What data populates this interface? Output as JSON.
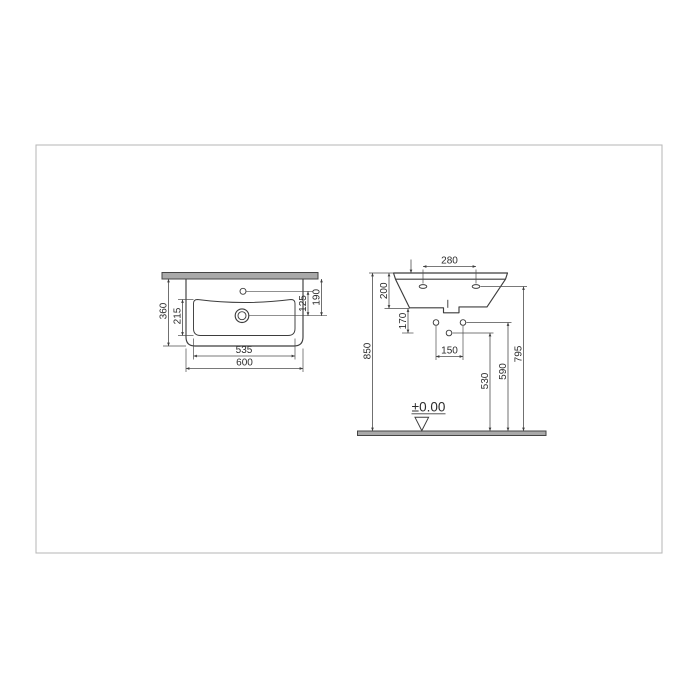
{
  "drawing": {
    "type": "technical-installation-drawing",
    "subject": "wall-hung washbasin dimensions (mm)",
    "plan_view": {
      "overall_width": "600",
      "bowl_width": "535",
      "overall_depth": "360",
      "bowl_depth": "215",
      "tap_hole_to_drain": "125",
      "wall_to_drain": "190"
    },
    "front_view": {
      "tap_deck_hole_spacing": "280",
      "basin_height": "200",
      "basin_bottom_to_drain": "170",
      "fixing_hole_spacing": "150",
      "floor_to_drain": "530",
      "floor_to_fixing_holes": "590",
      "floor_to_mounting_holes": "795",
      "floor_to_rim": "850",
      "floor_level": "±0.00"
    }
  }
}
